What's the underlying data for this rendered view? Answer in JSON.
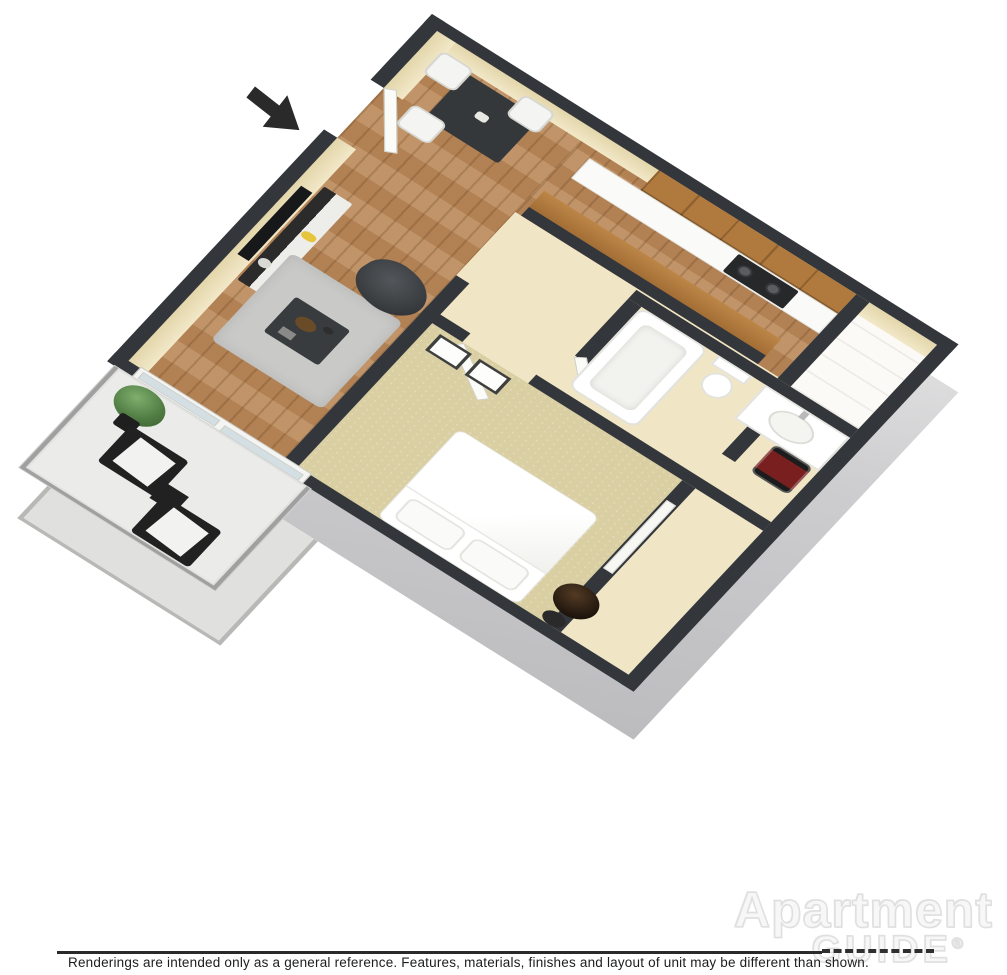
{
  "scene": {
    "description": "3D isometric cutaway floor plan rendering of a one-bedroom, one-bathroom apartment with balcony",
    "rooms": [
      "living-room",
      "dining-area",
      "kitchen",
      "hallway",
      "bathroom",
      "bedroom",
      "closets",
      "balcony"
    ],
    "furniture": [
      "wall-tv",
      "tv-console",
      "bean-bag-chair",
      "area-rug",
      "coffee-table",
      "dining-table",
      "dining-chairs",
      "wall-cabinets",
      "counter-with-stove",
      "breakfast-bar",
      "bathtub",
      "toilet",
      "sink-vanity",
      "bed-with-pillows",
      "nightstand",
      "wall-art-frames",
      "water-heater",
      "balcony-lounge-chairs",
      "potted-plant",
      "sliding-glass-door",
      "entry-door"
    ],
    "entry_marker": "black arrow pointing at entry door"
  },
  "colors": {
    "wall_top": "#33363a",
    "wall_face_beige": "#efe5c2",
    "room_floor_beige": "#f0e6c6",
    "wood_floor": "#b8885a",
    "bedroom_carpet": "#d9cfa2",
    "cabinet_wood": "#b07a3f",
    "exterior_wall_gray": "#d9d9db",
    "balcony_floor": "#ebebe9",
    "dark_furniture": "#3a3d40",
    "background": "#ffffff"
  },
  "footer": {
    "disclaimer": "Renderings are intended only as a general reference. Features, materials, finishes and layout of unit may be different than shown."
  },
  "watermark": {
    "brand_top": "Apartment",
    "brand_bottom": "GUIDE",
    "registered": "®"
  }
}
